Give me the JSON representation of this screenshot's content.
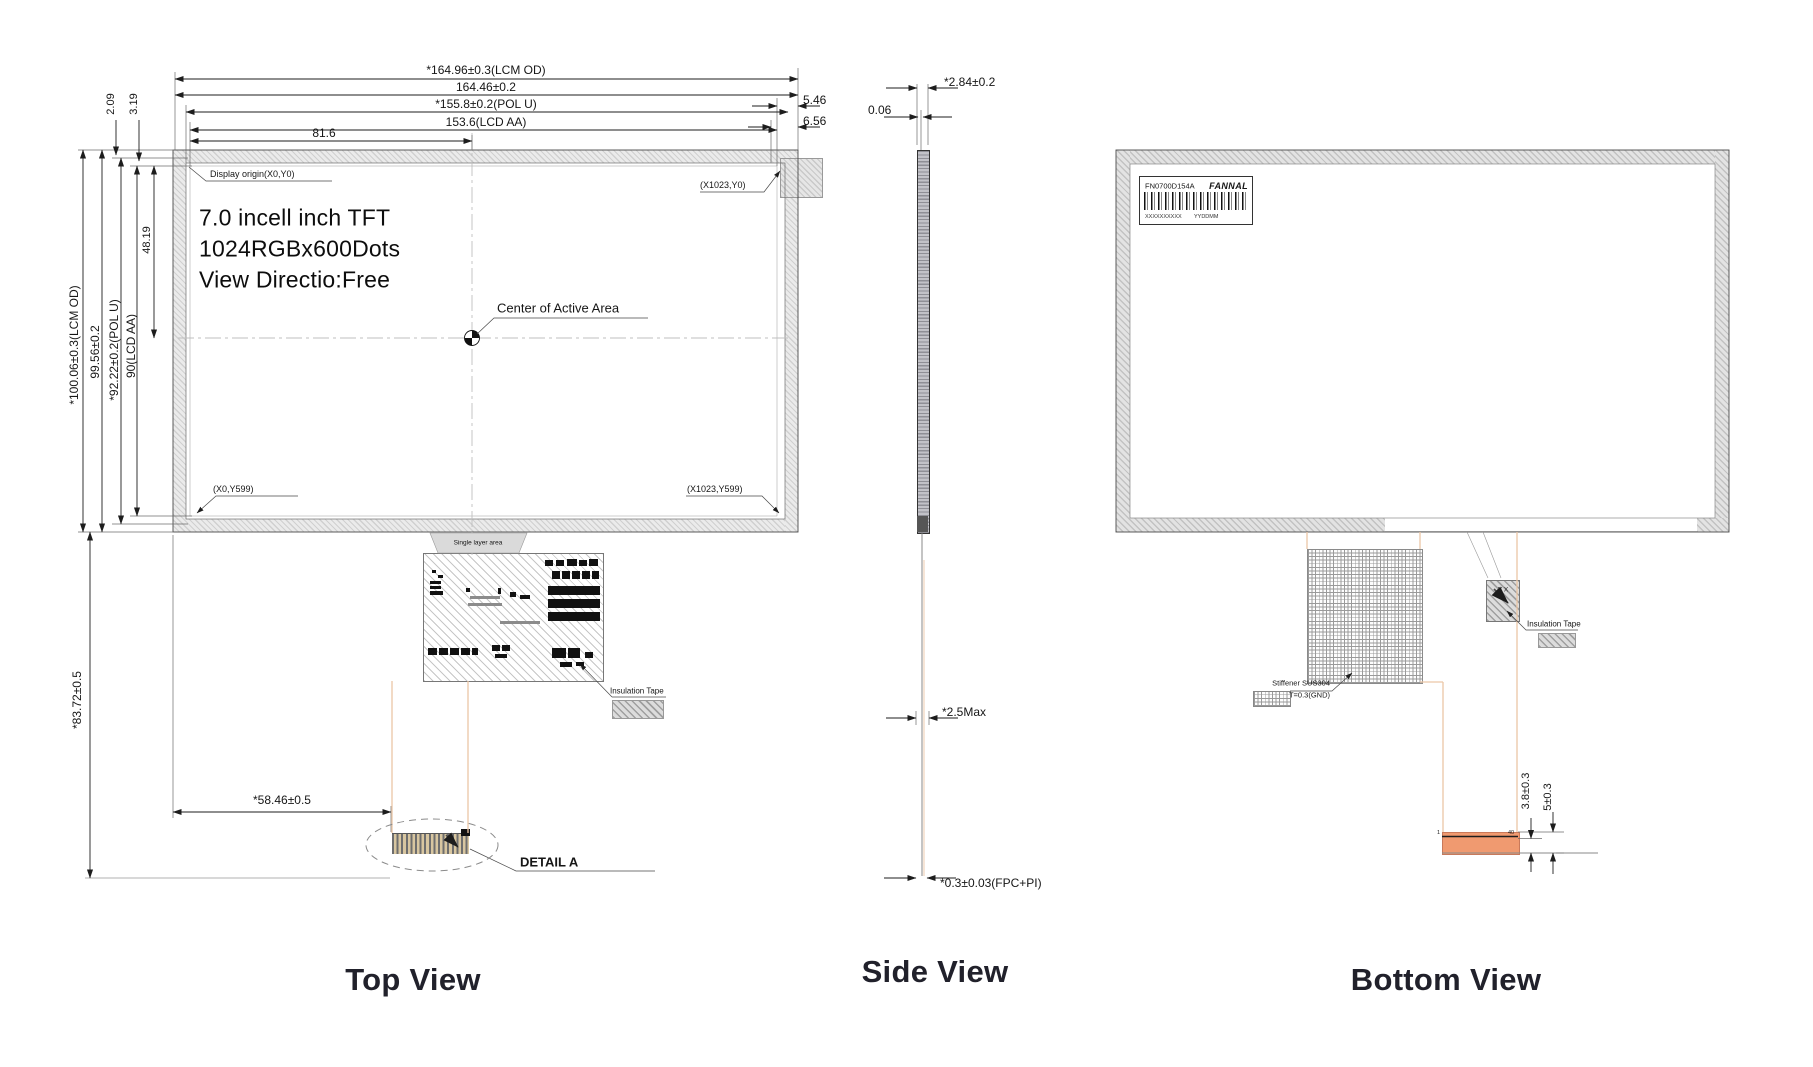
{
  "titles": {
    "top_view": "Top View",
    "side_view": "Side View",
    "bottom_view": "Bottom View"
  },
  "top_view": {
    "dim_width_lcm": "*164.96±0.3(LCM OD)",
    "dim_width_outline": "164.46±0.2",
    "dim_width_pol": "*155.8±0.2(POL U)",
    "dim_width_aa": "153.6(LCD AA)",
    "dim_width_half": "81.6",
    "dim_right_1": "5.46",
    "dim_right_2": "6.56",
    "dim_height_lcm": "*100.06±0.3(LCM OD)",
    "dim_height_outline": "99.56±0.2",
    "dim_height_pol": "*92.22±0.2(POL U)",
    "dim_height_aa": "90(LCD AA)",
    "dim_top_1": "2.09",
    "dim_top_2": "3.19",
    "dim_height_half": "48.19",
    "dim_fpc_length": "*83.72±0.5",
    "dim_connector_offset": "*58.46±0.5",
    "display_origin": "Display origin(X0,Y0)",
    "corner_top_right": "(X1023,Y0)",
    "corner_bottom_left": "(X0,Y599)",
    "corner_bottom_right": "(X1023,Y599)",
    "spec_line1": "7.0 incell inch TFT",
    "spec_line2": "1024RGBx600Dots",
    "spec_line3": "View Directio:Free",
    "center_label": "Center of Active Area",
    "single_layer_label": "Single layer area",
    "insulation_tape_label": "Insulation Tape",
    "detail_label": "DETAIL A"
  },
  "side_view": {
    "dim_thickness": "*2.84±0.2",
    "dim_offset": "0.06",
    "dim_max": "*2.5Max",
    "dim_fpc": "*0.3±0.03(FPC+PI)"
  },
  "bottom_view": {
    "label_model": "FN0700D154A",
    "label_brand": "FANNAL",
    "label_serial": "XXXXXXXXXX",
    "label_date": "YYDDMM",
    "stiffener_line1": "Stiffener SUS304",
    "stiffener_line2": "T=0.3(GND)",
    "insulation_tape_label": "Insulation Tape",
    "component_label": "Y X",
    "dim_connector_1": "3.8±0.3",
    "dim_connector_2": "5±0.3",
    "pin_first": "1",
    "pin_last": "40"
  },
  "colors": {
    "frame_gray": "#d8d8d8",
    "connector_orange": "#f09a70",
    "fpc_peach": "#ecc6a6",
    "title_color": "#21212b"
  }
}
